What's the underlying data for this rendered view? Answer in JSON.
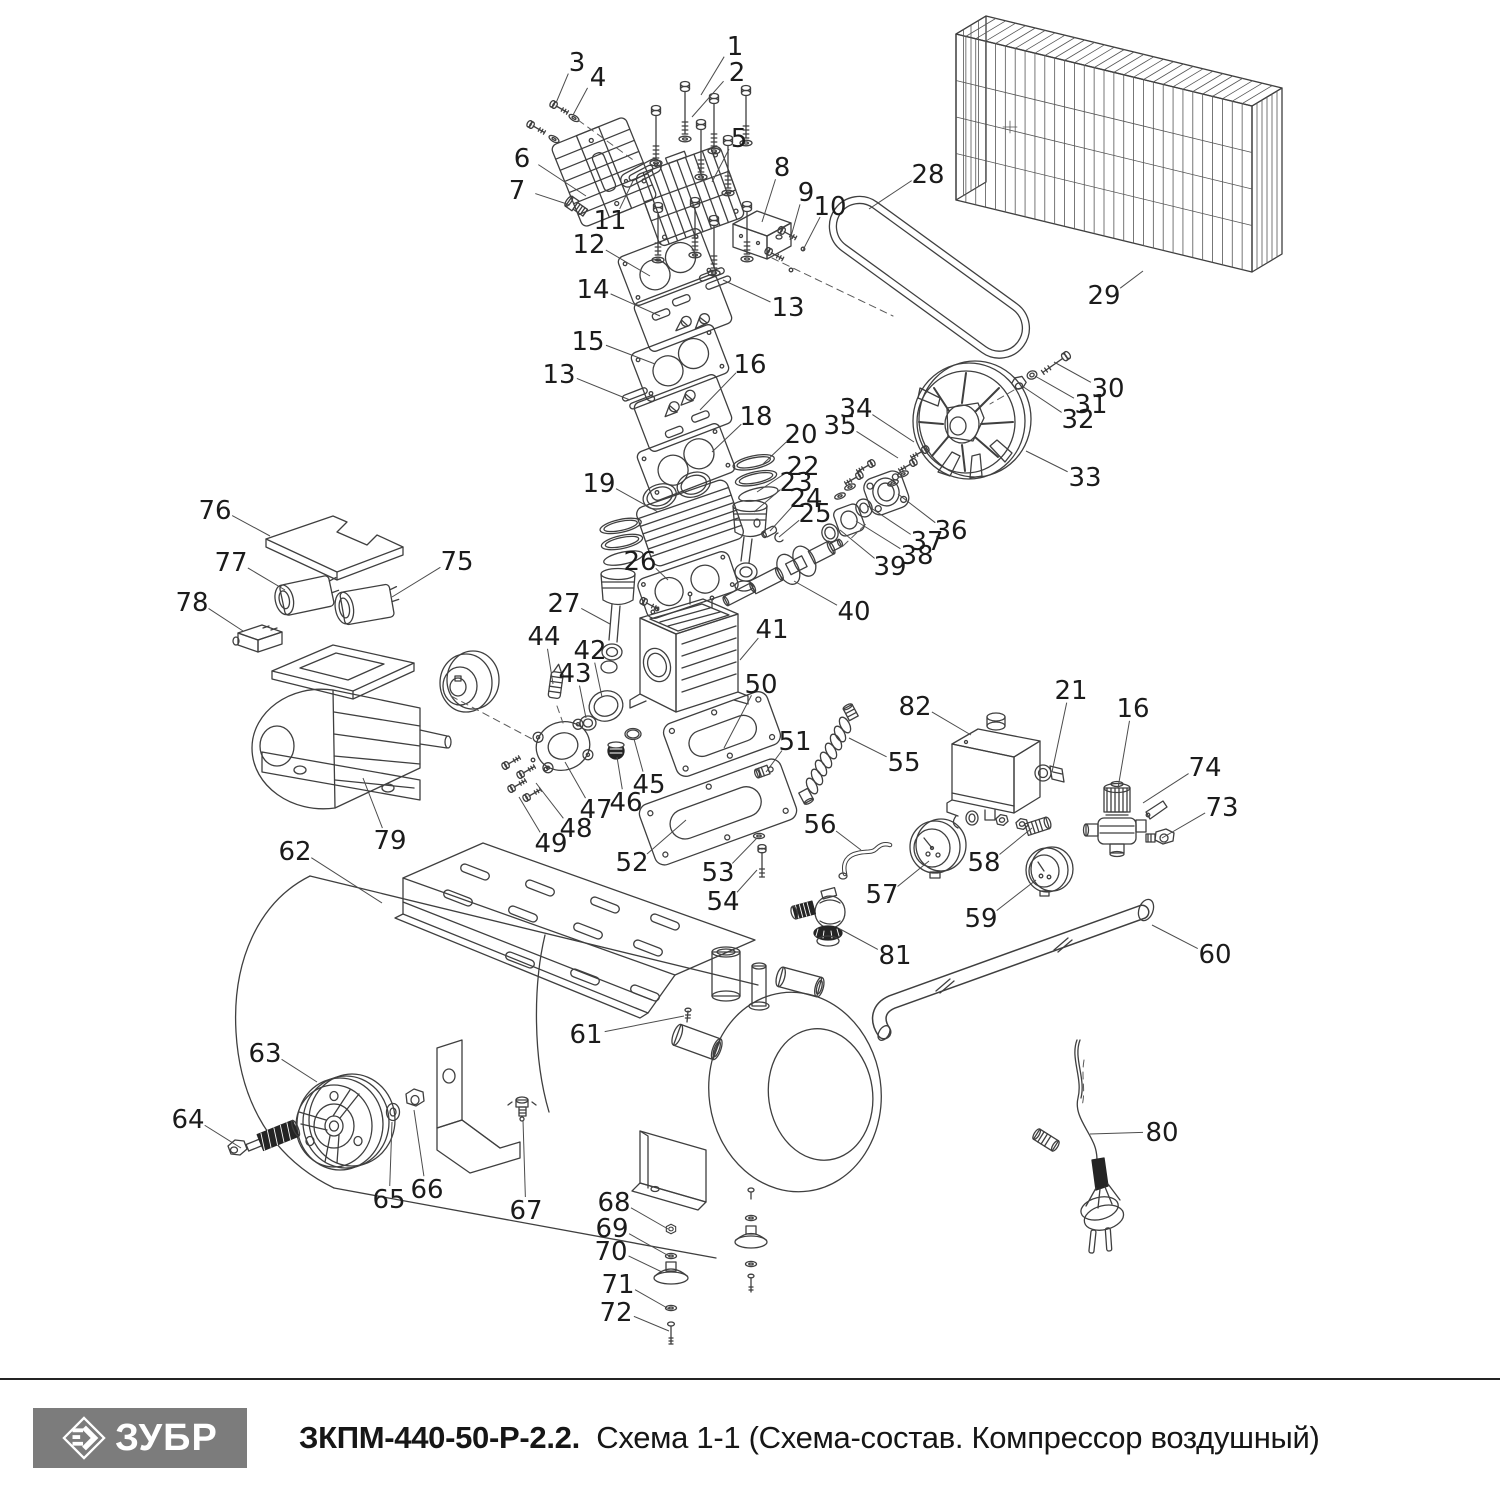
{
  "footer": {
    "brand": "ЗУБР",
    "brand_bg": "#7c7c7c",
    "title_bold": "ЗКПМ-440-50-Р-2.2.",
    "title_rest": "Схема 1-1 (Схема-состав. Компрессор воздушный)"
  },
  "colors": {
    "line": "#3f3f3f",
    "label": "#1b1b1b",
    "leader": "#4c4c4c"
  },
  "diagram": {
    "labels": [
      {
        "n": "1",
        "x": 735,
        "y": 46,
        "tx": 701,
        "ty": 95
      },
      {
        "n": "2",
        "x": 737,
        "y": 72,
        "tx": 692,
        "ty": 117
      },
      {
        "n": "3",
        "x": 577,
        "y": 62,
        "tx": 556,
        "ty": 103
      },
      {
        "n": "4",
        "x": 598,
        "y": 77,
        "tx": 573,
        "ty": 115
      },
      {
        "n": "5",
        "x": 739,
        "y": 138,
        "tx": 712,
        "ty": 182
      },
      {
        "n": "6",
        "x": 522,
        "y": 158,
        "tx": 586,
        "ty": 196
      },
      {
        "n": "7",
        "x": 517,
        "y": 190,
        "tx": 570,
        "ty": 205
      },
      {
        "n": "8",
        "x": 782,
        "y": 167,
        "tx": 762,
        "ty": 222
      },
      {
        "n": "9",
        "x": 806,
        "y": 192,
        "tx": 790,
        "ty": 240
      },
      {
        "n": "10",
        "x": 830,
        "y": 206,
        "tx": 803,
        "ty": 250
      },
      {
        "n": "11",
        "x": 610,
        "y": 220,
        "tx": 633,
        "ty": 181
      },
      {
        "n": "12",
        "x": 589,
        "y": 244,
        "tx": 650,
        "ty": 276
      },
      {
        "n": "13",
        "x": 788,
        "y": 307,
        "tx": 723,
        "ty": 280
      },
      {
        "n": "14",
        "x": 593,
        "y": 289,
        "tx": 660,
        "ty": 316
      },
      {
        "n": "15",
        "x": 588,
        "y": 341,
        "tx": 655,
        "ty": 364
      },
      {
        "n": "13",
        "x": 559,
        "y": 374,
        "tx": 630,
        "ty": 400
      },
      {
        "n": "16",
        "x": 750,
        "y": 364,
        "tx": 700,
        "ty": 410
      },
      {
        "n": "18",
        "x": 756,
        "y": 416,
        "tx": 712,
        "ty": 452
      },
      {
        "n": "19",
        "x": 599,
        "y": 483,
        "tx": 658,
        "ty": 512
      },
      {
        "n": "20",
        "x": 801,
        "y": 434,
        "tx": 762,
        "ty": 465
      },
      {
        "n": "22",
        "x": 803,
        "y": 466,
        "tx": 757,
        "ty": 492
      },
      {
        "n": "23",
        "x": 796,
        "y": 482,
        "tx": 754,
        "ty": 512
      },
      {
        "n": "24",
        "x": 806,
        "y": 498,
        "tx": 770,
        "ty": 531
      },
      {
        "n": "25",
        "x": 815,
        "y": 513,
        "tx": 779,
        "ty": 537
      },
      {
        "n": "26",
        "x": 640,
        "y": 561,
        "tx": 668,
        "ty": 580
      },
      {
        "n": "27",
        "x": 564,
        "y": 603,
        "tx": 610,
        "ty": 624
      },
      {
        "n": "28",
        "x": 928,
        "y": 174,
        "tx": 869,
        "ty": 209
      },
      {
        "n": "29",
        "x": 1104,
        "y": 295,
        "tx": 1143,
        "ty": 271
      },
      {
        "n": "30",
        "x": 1108,
        "y": 388,
        "tx": 1054,
        "ty": 362
      },
      {
        "n": "31",
        "x": 1091,
        "y": 404,
        "tx": 1035,
        "ty": 376
      },
      {
        "n": "32",
        "x": 1078,
        "y": 419,
        "tx": 1022,
        "ty": 386
      },
      {
        "n": "33",
        "x": 1085,
        "y": 477,
        "tx": 1026,
        "ty": 451
      },
      {
        "n": "34",
        "x": 856,
        "y": 408,
        "tx": 914,
        "ty": 442
      },
      {
        "n": "35",
        "x": 840,
        "y": 425,
        "tx": 898,
        "ty": 458
      },
      {
        "n": "36",
        "x": 951,
        "y": 530,
        "tx": 898,
        "ty": 494
      },
      {
        "n": "37",
        "x": 927,
        "y": 541,
        "tx": 868,
        "ty": 506
      },
      {
        "n": "38",
        "x": 917,
        "y": 555,
        "tx": 856,
        "ty": 521
      },
      {
        "n": "39",
        "x": 890,
        "y": 566,
        "tx": 840,
        "ty": 530
      },
      {
        "n": "40",
        "x": 854,
        "y": 611,
        "tx": 794,
        "ty": 581
      },
      {
        "n": "41",
        "x": 772,
        "y": 629,
        "tx": 740,
        "ty": 660
      },
      {
        "n": "42",
        "x": 590,
        "y": 650,
        "tx": 602,
        "ty": 697
      },
      {
        "n": "43",
        "x": 575,
        "y": 673,
        "tx": 586,
        "ty": 718
      },
      {
        "n": "44",
        "x": 544,
        "y": 636,
        "tx": 553,
        "ty": 684
      },
      {
        "n": "45",
        "x": 649,
        "y": 784,
        "tx": 634,
        "ty": 739
      },
      {
        "n": "46",
        "x": 626,
        "y": 802,
        "tx": 617,
        "ty": 757
      },
      {
        "n": "47",
        "x": 596,
        "y": 809,
        "tx": 565,
        "ty": 762
      },
      {
        "n": "48",
        "x": 576,
        "y": 828,
        "tx": 536,
        "ty": 783
      },
      {
        "n": "49",
        "x": 551,
        "y": 843,
        "tx": 519,
        "ty": 797
      },
      {
        "n": "50",
        "x": 761,
        "y": 684,
        "tx": 724,
        "ty": 748
      },
      {
        "n": "51",
        "x": 795,
        "y": 741,
        "tx": 766,
        "ty": 772
      },
      {
        "n": "52",
        "x": 632,
        "y": 862,
        "tx": 686,
        "ty": 820
      },
      {
        "n": "53",
        "x": 718,
        "y": 872,
        "tx": 757,
        "ty": 838
      },
      {
        "n": "54",
        "x": 723,
        "y": 901,
        "tx": 757,
        "ty": 870
      },
      {
        "n": "55",
        "x": 904,
        "y": 762,
        "tx": 849,
        "ty": 738
      },
      {
        "n": "56",
        "x": 820,
        "y": 824,
        "tx": 861,
        "ty": 850
      },
      {
        "n": "57",
        "x": 882,
        "y": 894,
        "tx": 929,
        "ty": 861
      },
      {
        "n": "58",
        "x": 984,
        "y": 862,
        "tx": 1032,
        "ty": 828
      },
      {
        "n": "59",
        "x": 981,
        "y": 918,
        "tx": 1036,
        "ty": 880
      },
      {
        "n": "60",
        "x": 1215,
        "y": 954,
        "tx": 1152,
        "ty": 925
      },
      {
        "n": "61",
        "x": 586,
        "y": 1034,
        "tx": 684,
        "ty": 1016
      },
      {
        "n": "62",
        "x": 295,
        "y": 851,
        "tx": 382,
        "ty": 903
      },
      {
        "n": "63",
        "x": 265,
        "y": 1053,
        "tx": 317,
        "ty": 1082
      },
      {
        "n": "64",
        "x": 188,
        "y": 1119,
        "tx": 241,
        "ty": 1148
      },
      {
        "n": "65",
        "x": 389,
        "y": 1199,
        "tx": 392,
        "ty": 1122
      },
      {
        "n": "66",
        "x": 427,
        "y": 1189,
        "tx": 414,
        "ty": 1110
      },
      {
        "n": "67",
        "x": 526,
        "y": 1210,
        "tx": 523,
        "ty": 1120
      },
      {
        "n": "68",
        "x": 614,
        "y": 1202,
        "tx": 668,
        "ty": 1229
      },
      {
        "n": "69",
        "x": 612,
        "y": 1228,
        "tx": 669,
        "ty": 1256
      },
      {
        "n": "70",
        "x": 611,
        "y": 1251,
        "tx": 662,
        "ty": 1272
      },
      {
        "n": "71",
        "x": 618,
        "y": 1284,
        "tx": 669,
        "ty": 1309
      },
      {
        "n": "72",
        "x": 616,
        "y": 1312,
        "tx": 669,
        "ty": 1331
      },
      {
        "n": "73",
        "x": 1222,
        "y": 807,
        "tx": 1162,
        "ty": 838
      },
      {
        "n": "74",
        "x": 1205,
        "y": 767,
        "tx": 1143,
        "ty": 803
      },
      {
        "n": "75",
        "x": 457,
        "y": 561,
        "tx": 392,
        "ty": 597
      },
      {
        "n": "76",
        "x": 215,
        "y": 510,
        "tx": 270,
        "ty": 536
      },
      {
        "n": "77",
        "x": 231,
        "y": 562,
        "tx": 285,
        "ty": 590
      },
      {
        "n": "78",
        "x": 192,
        "y": 602,
        "tx": 243,
        "ty": 631
      },
      {
        "n": "79",
        "x": 390,
        "y": 840,
        "tx": 363,
        "ty": 778
      },
      {
        "n": "80",
        "x": 1162,
        "y": 1132,
        "tx": 1090,
        "ty": 1134
      },
      {
        "n": "81",
        "x": 895,
        "y": 955,
        "tx": 840,
        "ty": 929
      },
      {
        "n": "82",
        "x": 915,
        "y": 706,
        "tx": 971,
        "ty": 735
      },
      {
        "n": "16",
        "x": 1133,
        "y": 708,
        "tx": 1118,
        "ty": 788
      },
      {
        "n": "21",
        "x": 1071,
        "y": 690,
        "tx": 1052,
        "ty": 772
      }
    ]
  }
}
